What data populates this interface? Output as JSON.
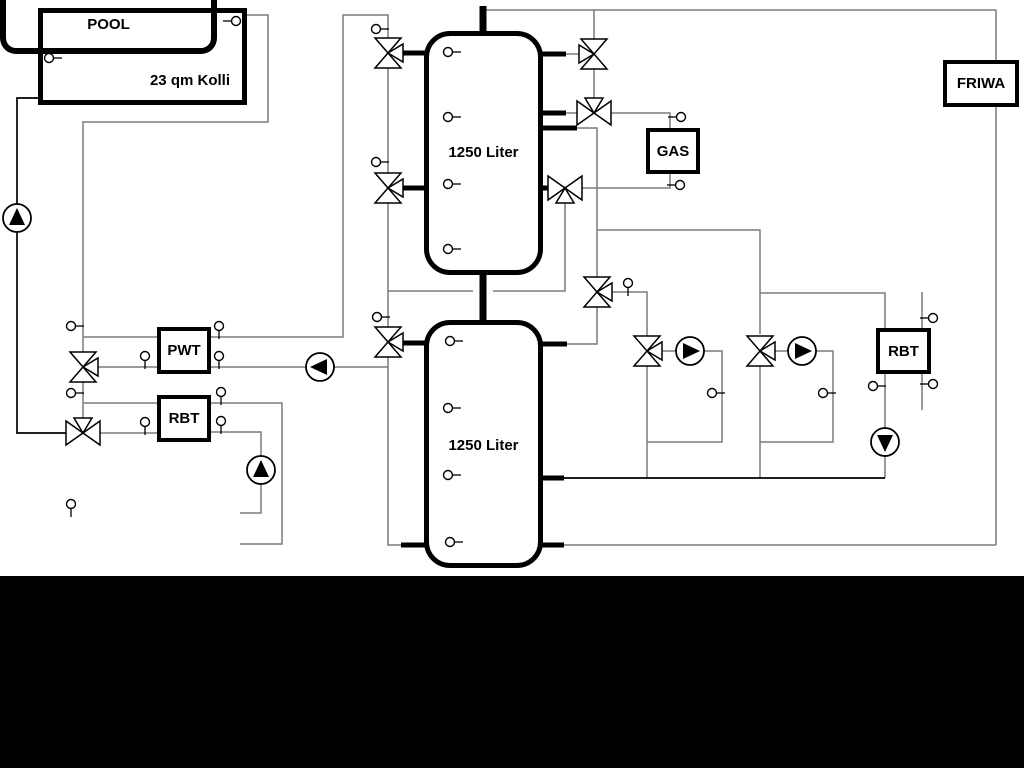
{
  "diagram_title": "Solar / buffer tank / pool hydraulic schematic",
  "boxes": {
    "collector": {
      "label": "23 qm Kolli"
    },
    "tank_top": {
      "label": "1250 Liter"
    },
    "tank_bottom": {
      "label": "1250 Liter"
    },
    "gas_boiler": {
      "label": "GAS"
    },
    "friwa": {
      "label": "FRIWA"
    },
    "pwt": {
      "label": "PWT"
    },
    "rbt_left": {
      "label": "RBT"
    },
    "rbt_right": {
      "label": "RBT"
    },
    "pool": {
      "label": "POOL"
    }
  },
  "icons": {
    "pump": "circle-with-filled-triangle",
    "valve": "bowtie-triangle-valve",
    "three_way_valve": "bowtie-with-side-triangle",
    "sensor": "small-circle-probe"
  },
  "colors": {
    "line_gray": "#7b7b7b",
    "line_black": "#000000",
    "background": "#ffffff",
    "bottom_bar": "#000000"
  }
}
